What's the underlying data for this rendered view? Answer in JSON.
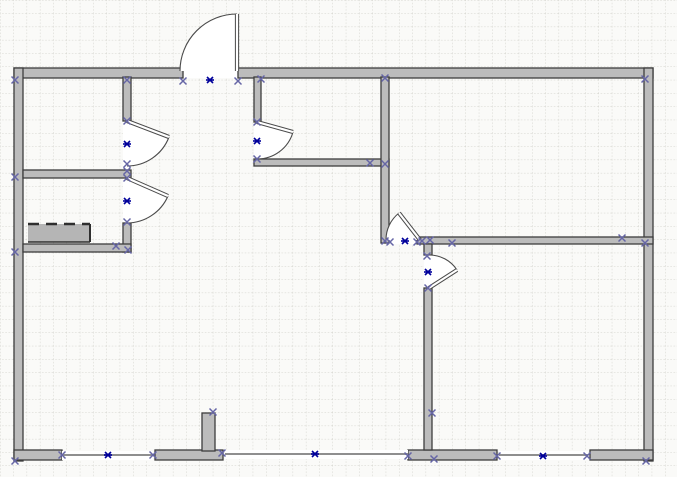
{
  "meta": {
    "kind": "floor-plan-drawing",
    "description": "CAD/Visio-style floor plan with walls, swing doors, wall openings, connection-point markers and anchor markers on a dotted grid page"
  },
  "canvas": {
    "width": 677,
    "height": 477,
    "background": "#fafaf8",
    "grid": {
      "spacing": 13.3,
      "color": "#d2d2cb",
      "dash": "1.6,1.6"
    }
  },
  "palette": {
    "wall_fill": "#bcbcbc",
    "wall_stroke": "#3d3d3d",
    "door_line": "#4a4a4a",
    "leaf_core": "#ffffff",
    "opening_line": "#8f8f8f",
    "connection_x": "#6666a6",
    "anchor_blue": "#00009b",
    "counter_fill": "#b5b5b5",
    "counter_edge": "#2f2f2f"
  },
  "walls": [
    {
      "x": 14,
      "y": 68,
      "w": 169,
      "h": 10,
      "name": "top-wall-left"
    },
    {
      "x": 238,
      "y": 68,
      "w": 415,
      "h": 10,
      "name": "top-wall-right"
    },
    {
      "x": 14,
      "y": 68,
      "w": 9,
      "h": 393,
      "name": "left-wall"
    },
    {
      "x": 644,
      "y": 68,
      "w": 9,
      "h": 393,
      "name": "right-wall"
    },
    {
      "x": 14,
      "y": 450,
      "w": 48,
      "h": 10,
      "name": "bottom-wall-seg-1"
    },
    {
      "x": 155,
      "y": 450,
      "w": 68,
      "h": 10,
      "name": "bottom-wall-seg-2"
    },
    {
      "x": 408,
      "y": 450,
      "w": 89,
      "h": 10,
      "name": "bottom-wall-seg-3"
    },
    {
      "x": 590,
      "y": 450,
      "w": 63,
      "h": 10,
      "name": "bottom-wall-seg-4"
    },
    {
      "x": 202,
      "y": 413,
      "w": 13,
      "h": 38,
      "name": "bottom-wall-stub"
    },
    {
      "x": 123,
      "y": 77,
      "w": 8,
      "h": 44,
      "name": "closet-wall-upper"
    },
    {
      "x": 123,
      "y": 223,
      "w": 8,
      "h": 29,
      "name": "closet-wall-lower"
    },
    {
      "x": 23,
      "y": 170,
      "w": 108,
      "h": 8,
      "name": "left-room-divider"
    },
    {
      "x": 23,
      "y": 244,
      "w": 108,
      "h": 8,
      "name": "left-room-bottom-wall"
    },
    {
      "x": 254,
      "y": 77,
      "w": 7,
      "h": 45,
      "name": "hall-wall-vertical"
    },
    {
      "x": 254,
      "y": 159,
      "w": 135,
      "h": 7,
      "name": "hall-wall-horizontal"
    },
    {
      "x": 381,
      "y": 77,
      "w": 8,
      "h": 166,
      "name": "center-wall-vertical"
    },
    {
      "x": 417,
      "y": 237,
      "w": 236,
      "h": 7,
      "name": "right-room-divider"
    },
    {
      "x": 424,
      "y": 244,
      "w": 8,
      "h": 11,
      "name": "lower-right-wall-stub"
    },
    {
      "x": 424,
      "y": 288,
      "w": 8,
      "h": 162,
      "name": "lower-right-wall-vertical"
    }
  ],
  "door_openings": [
    {
      "x": 184,
      "y": 68,
      "w": 53,
      "h": 10
    },
    {
      "x": 123,
      "y": 121,
      "w": 8,
      "h": 49
    },
    {
      "x": 123,
      "y": 178,
      "w": 8,
      "h": 45
    },
    {
      "x": 254,
      "y": 122,
      "w": 7,
      "h": 37
    },
    {
      "x": 389,
      "y": 237,
      "w": 28,
      "h": 7
    },
    {
      "x": 424,
      "y": 255,
      "w": 8,
      "h": 33
    }
  ],
  "thin_walls": [
    {
      "x1": 62,
      "y1": 455,
      "x2": 153,
      "y2": 455
    },
    {
      "x1": 225,
      "y1": 454,
      "x2": 408,
      "y2": 454
    },
    {
      "x1": 499,
      "y1": 455,
      "x2": 588,
      "y2": 455
    }
  ],
  "counter": {
    "x": 28,
    "y": 224,
    "w": 62,
    "h": 18
  },
  "doors": [
    {
      "name": "door-top-entry",
      "leaf": [
        237,
        71,
        237,
        14
      ],
      "arc": "M 237 14 A 57 57 0 0 0 180 71",
      "sector": "M 237 71 L 237 14 A 57 57 0 0 0 180 71 Z"
    },
    {
      "name": "door-left-upper",
      "leaf": [
        127,
        121,
        169,
        137
      ],
      "arc": "M 169 137 A 45 45 0 0 1 127 166",
      "sector": "M 127 121 L 169 137 A 45 45 0 0 1 127 166 Z"
    },
    {
      "name": "door-left-lower",
      "leaf": [
        127,
        178,
        168,
        196
      ],
      "arc": "M 168 196 A 45 45 0 0 1 127 223",
      "sector": "M 127 178 L 168 196 A 45 45 0 0 1 127 223 Z"
    },
    {
      "name": "door-hallway",
      "leaf": [
        257,
        122,
        293,
        132
      ],
      "arc": "M 293 132 A 37 37 0 0 1 257 159",
      "sector": "M 257 122 L 293 132 A 37 37 0 0 1 257 159 Z"
    },
    {
      "name": "door-center-room",
      "leaf": [
        420,
        240,
        399,
        213
      ],
      "arc": "M 399 213 A 34 34 0 0 0 386 240",
      "sector": "M 420 240 L 399 213 A 34 34 0 0 0 386 240 Z"
    },
    {
      "name": "door-lower-right",
      "leaf": [
        429,
        288,
        457,
        270
      ],
      "arc": "M 429 255 A 33 33 0 0 1 457 270",
      "sector": "M 429 288 L 429 255 A 33 33 0 0 1 457 270 Z"
    }
  ],
  "markers": {
    "connection_points": [
      [
        15,
        80
      ],
      [
        127,
        80
      ],
      [
        183,
        81
      ],
      [
        238,
        81
      ],
      [
        261,
        79
      ],
      [
        385,
        78
      ],
      [
        645,
        79
      ],
      [
        15,
        177
      ],
      [
        15,
        252
      ],
      [
        15,
        461
      ],
      [
        127,
        121
      ],
      [
        127,
        164
      ],
      [
        127,
        171
      ],
      [
        127,
        178
      ],
      [
        127,
        222
      ],
      [
        116,
        246
      ],
      [
        128,
        250
      ],
      [
        257,
        122
      ],
      [
        257,
        159
      ],
      [
        370,
        163
      ],
      [
        385,
        164
      ],
      [
        385,
        241
      ],
      [
        390,
        242
      ],
      [
        417,
        242
      ],
      [
        422,
        241
      ],
      [
        430,
        240
      ],
      [
        452,
        243
      ],
      [
        622,
        238
      ],
      [
        645,
        243
      ],
      [
        427,
        256
      ],
      [
        428,
        288
      ],
      [
        432,
        413
      ],
      [
        434,
        459
      ],
      [
        62,
        455
      ],
      [
        153,
        455
      ],
      [
        213,
        412
      ],
      [
        222,
        453
      ],
      [
        408,
        456
      ],
      [
        497,
        456
      ],
      [
        587,
        456
      ],
      [
        646,
        461
      ]
    ],
    "anchors": [
      [
        210,
        80
      ],
      [
        127,
        144
      ],
      [
        127,
        201
      ],
      [
        257,
        141
      ],
      [
        405,
        241
      ],
      [
        428,
        272
      ],
      [
        108,
        455
      ],
      [
        315,
        454
      ],
      [
        543,
        456
      ]
    ]
  }
}
